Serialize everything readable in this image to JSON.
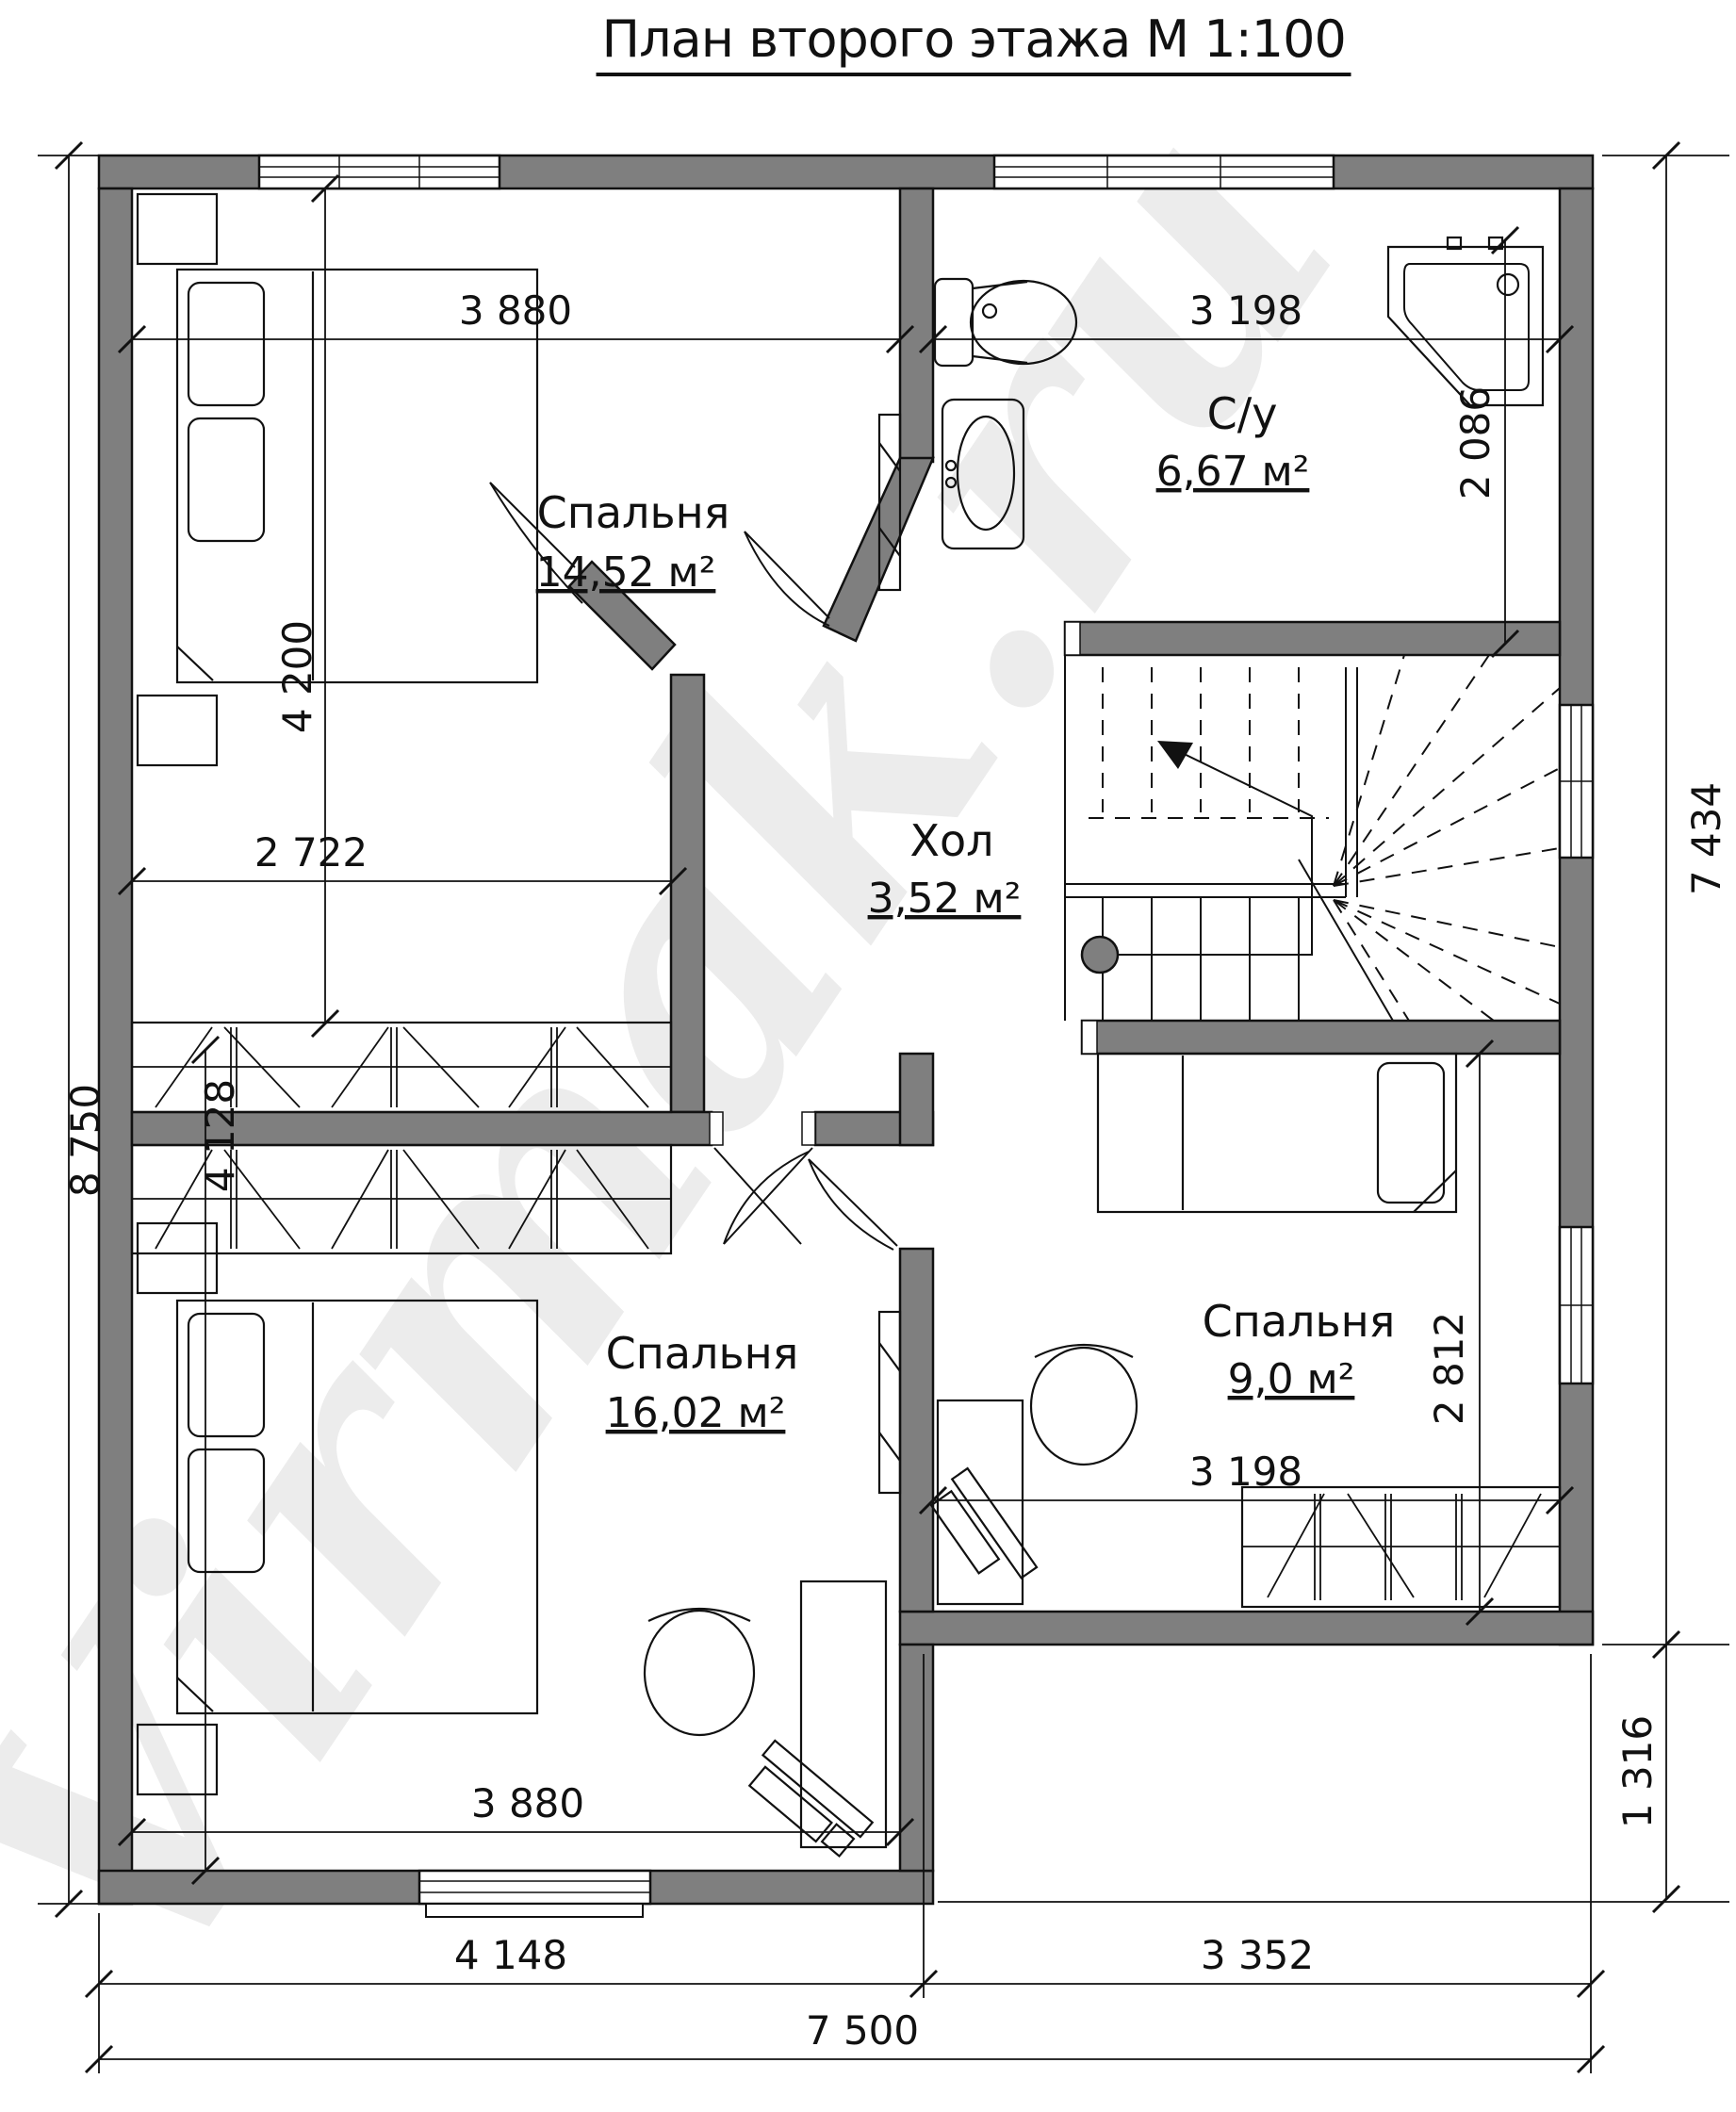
{
  "title": "План второго этажа М 1:100",
  "watermark": "Virmak.ru",
  "rooms": {
    "bedroom1": {
      "name": "Спальня",
      "area": "14,52 м²"
    },
    "bathroom": {
      "name": "С/у",
      "area": "6,67 м²"
    },
    "hall": {
      "name": "Хол",
      "area": "3,52 м²"
    },
    "bedroom2": {
      "name": "Спальня",
      "area": "16,02 м²"
    },
    "bedroom3": {
      "name": "Спальня",
      "area": "9,0 м²"
    }
  },
  "dimensions": {
    "bedroom1_width": "3 880",
    "bathroom_width": "3 198",
    "bathroom_depth": "2 086",
    "bedroom1_depth": "4 200",
    "closet_width": "2 722",
    "overall_depth": "8 750",
    "right_side_depth": "7 434",
    "bedroom2_depth": "4 128",
    "bedroom3_depth": "2 812",
    "bedroom3_width": "3 198",
    "notch_depth": "1 316",
    "bedroom2_width": "3 880",
    "bottom_left_width": "4 148",
    "bottom_right_width": "3 352",
    "overall_width": "7 500"
  }
}
